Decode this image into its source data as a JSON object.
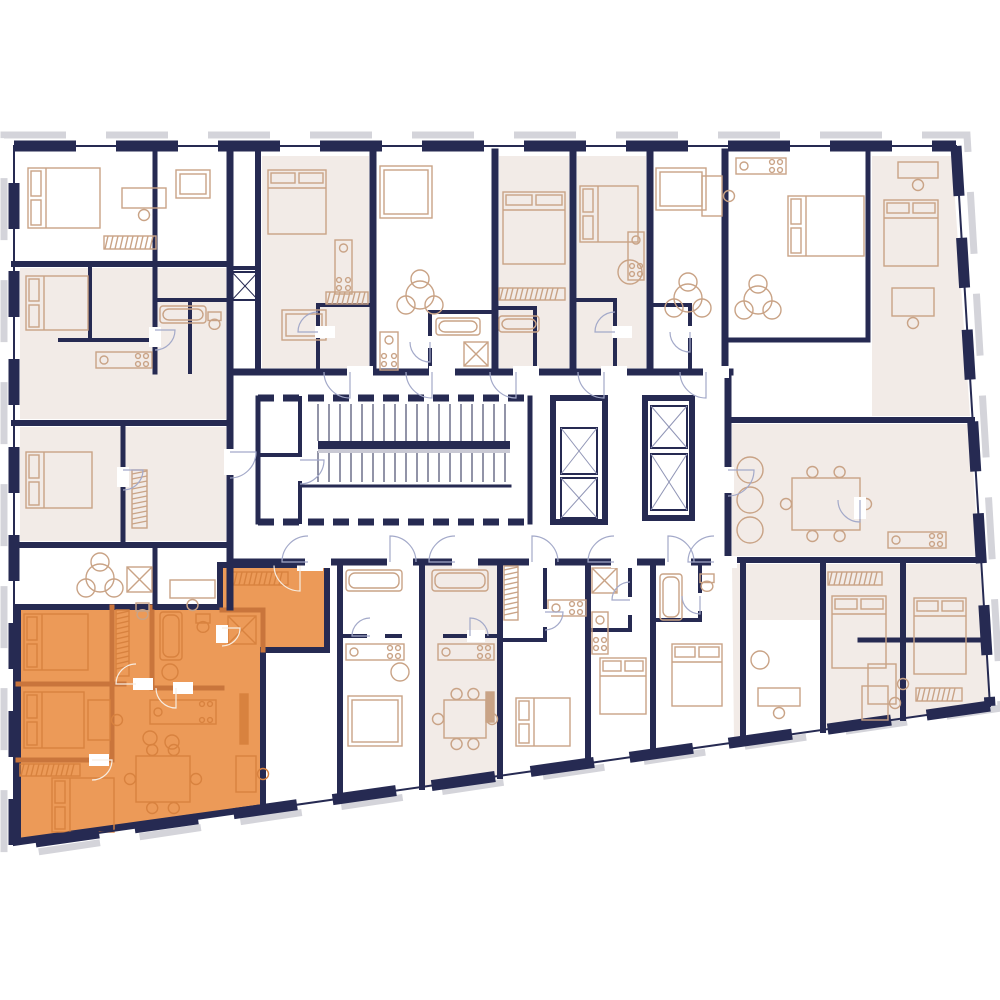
{
  "canvas": {
    "w": 1000,
    "h": 1000,
    "bg": "#ffffff"
  },
  "palette": {
    "wall_navy": "#262a52",
    "furniture_tan": "#c9a386",
    "room_pink": "#f2ebe7",
    "highlight_orange": "#EC9A58",
    "highlight_wall": "#c9753c",
    "highlight_furniture": "#d8823f",
    "door_arc": "#a3a9c9",
    "door_arc_light": "#f7ede2",
    "hatch_gray": "#d4d4da",
    "stair_shadow": "#c9c9d4",
    "white": "#ffffff"
  },
  "building": {
    "outline_points": [
      [
        14,
        146
      ],
      [
        956,
        146
      ],
      [
        990,
        706
      ],
      [
        14,
        845
      ]
    ],
    "hatch_points": [
      [
        4,
        135
      ],
      [
        967,
        135
      ],
      [
        1001,
        708
      ],
      [
        4,
        857
      ]
    ],
    "wall_thickness": 11,
    "edge_dashes": {
      "top": "62 40",
      "right": "50 42",
      "bottom": "64 36",
      "left": "46 42"
    }
  },
  "pink_rooms": [
    [
      [
        20,
        268
      ],
      [
        226,
        268
      ],
      [
        226,
        419
      ],
      [
        20,
        419
      ]
    ],
    [
      [
        20,
        427
      ],
      [
        226,
        427
      ],
      [
        226,
        541
      ],
      [
        20,
        541
      ]
    ],
    [
      [
        262,
        156
      ],
      [
        369,
        156
      ],
      [
        369,
        368
      ],
      [
        262,
        368
      ]
    ],
    [
      [
        499,
        156
      ],
      [
        569,
        156
      ],
      [
        569,
        368
      ],
      [
        499,
        368
      ]
    ],
    [
      [
        577,
        156
      ],
      [
        646,
        156
      ],
      [
        646,
        368
      ],
      [
        577,
        368
      ]
    ],
    [
      [
        872,
        156
      ],
      [
        952,
        156
      ],
      [
        970,
        416
      ],
      [
        872,
        416
      ]
    ],
    [
      [
        732,
        424
      ],
      [
        970,
        424
      ],
      [
        979,
        556
      ],
      [
        732,
        556
      ]
    ],
    [
      [
        732,
        564
      ],
      [
        980,
        564
      ],
      [
        990,
        706
      ],
      [
        734,
        740
      ]
    ],
    [
      [
        425,
        565
      ],
      [
        497,
        565
      ],
      [
        497,
        777
      ],
      [
        425,
        788
      ]
    ]
  ],
  "white_overlays": [
    [
      [
        746,
        620
      ],
      [
        820,
        620
      ],
      [
        820,
        730
      ],
      [
        746,
        739
      ]
    ]
  ],
  "walls": [
    [
      230,
      152,
      230,
      607,
      7
    ],
    [
      14,
      264,
      230,
      264,
      6
    ],
    [
      155,
      152,
      155,
      264,
      5
    ],
    [
      90,
      264,
      90,
      340,
      4
    ],
    [
      60,
      340,
      155,
      340,
      4
    ],
    [
      155,
      264,
      155,
      372,
      5
    ],
    [
      155,
      300,
      230,
      300,
      4
    ],
    [
      190,
      300,
      190,
      372,
      4
    ],
    [
      14,
      423,
      230,
      423,
      6
    ],
    [
      123,
      427,
      123,
      545,
      5
    ],
    [
      14,
      545,
      230,
      545,
      6
    ],
    [
      155,
      545,
      155,
      607,
      5
    ],
    [
      258,
      152,
      258,
      372,
      6
    ],
    [
      232,
      268,
      258,
      268,
      4
    ],
    [
      318,
      305,
      373,
      305,
      4
    ],
    [
      318,
      305,
      318,
      372,
      4
    ],
    [
      373,
      152,
      373,
      372,
      7
    ],
    [
      430,
      312,
      495,
      312,
      4
    ],
    [
      430,
      312,
      430,
      372,
      4
    ],
    [
      495,
      152,
      495,
      372,
      7
    ],
    [
      495,
      308,
      535,
      308,
      4
    ],
    [
      535,
      308,
      535,
      372,
      4
    ],
    [
      573,
      152,
      573,
      372,
      7
    ],
    [
      573,
      300,
      615,
      300,
      4
    ],
    [
      615,
      300,
      615,
      372,
      4
    ],
    [
      650,
      152,
      650,
      372,
      7
    ],
    [
      650,
      305,
      690,
      305,
      4
    ],
    [
      690,
      305,
      690,
      372,
      4
    ],
    [
      725,
      152,
      725,
      372,
      7
    ],
    [
      725,
      340,
      868,
      340,
      5
    ],
    [
      868,
      152,
      868,
      340,
      5
    ],
    [
      230,
      372,
      730,
      372,
      7
    ],
    [
      230,
      562,
      730,
      562,
      7
    ],
    [
      728,
      372,
      728,
      562,
      7
    ],
    [
      728,
      420,
      972,
      420,
      6
    ],
    [
      728,
      560,
      980,
      560,
      6
    ],
    [
      340,
      562,
      340,
      798,
      6
    ],
    [
      422,
      562,
      422,
      787,
      6
    ],
    [
      500,
      562,
      500,
      776,
      6
    ],
    [
      588,
      562,
      588,
      763,
      6
    ],
    [
      653,
      562,
      653,
      754,
      6
    ],
    [
      743,
      560,
      743,
      741,
      6
    ],
    [
      823,
      560,
      823,
      730,
      6
    ],
    [
      903,
      560,
      903,
      718,
      6
    ],
    [
      340,
      636,
      400,
      636,
      4
    ],
    [
      445,
      636,
      500,
      636,
      4
    ],
    [
      545,
      562,
      545,
      640,
      4
    ],
    [
      500,
      640,
      545,
      640,
      4
    ],
    [
      588,
      630,
      630,
      630,
      4
    ],
    [
      630,
      562,
      630,
      630,
      4
    ],
    [
      653,
      620,
      700,
      620,
      4
    ],
    [
      700,
      562,
      700,
      620,
      4
    ],
    [
      860,
      640,
      986,
      640,
      5
    ],
    [
      258,
      398,
      258,
      522,
      5
    ],
    [
      300,
      398,
      300,
      522,
      4
    ],
    [
      258,
      455,
      300,
      455,
      4
    ],
    [
      530,
      398,
      530,
      522,
      5
    ],
    [
      302,
      486,
      510,
      486,
      3
    ]
  ],
  "stairs": {
    "x": 302,
    "y": 400,
    "w": 226,
    "h": 120,
    "tread_x1": 318,
    "tread_x2": 510,
    "step": 11,
    "band1": [
      404,
      441
    ],
    "band2": [
      451,
      482
    ],
    "mid_bar": [
      318,
      441,
      192,
      8
    ],
    "post_walls": [
      [
        258,
        398,
        530,
        398
      ],
      [
        258,
        522,
        530,
        522
      ]
    ],
    "post_dash": "16 9"
  },
  "elevators": {
    "banks": [
      [
        553,
        398,
        52,
        124
      ],
      [
        645,
        398,
        47,
        120
      ]
    ],
    "shafts": [
      [
        561,
        428,
        36,
        46
      ],
      [
        561,
        478,
        36,
        40
      ],
      [
        651,
        406,
        36,
        42
      ],
      [
        651,
        454,
        36,
        56
      ]
    ]
  },
  "small_shafts": [
    [
      232,
      272,
      26,
      28
    ]
  ],
  "furniture": [
    [
      "bed",
      28,
      168,
      72,
      60
    ],
    [
      "hatch",
      104,
      236,
      52,
      13
    ],
    [
      "desk",
      122,
      188,
      44,
      20
    ],
    [
      "sofa",
      176,
      170,
      34,
      28
    ],
    [
      "bed",
      26,
      276,
      62,
      54
    ],
    [
      "kitchen",
      96,
      352,
      56,
      16
    ],
    [
      "tub",
      160,
      306,
      46,
      17
    ],
    [
      "wc",
      208,
      312,
      13,
      17
    ],
    [
      "bed",
      26,
      452,
      66,
      56
    ],
    [
      "hatch",
      132,
      470,
      15,
      58
    ],
    [
      "shower",
      127,
      567,
      25,
      25
    ],
    [
      "wc",
      136,
      603,
      13,
      16
    ],
    [
      "rtable3",
      100,
      578,
      0,
      0
    ],
    [
      "desk",
      170,
      580,
      45,
      18
    ],
    [
      "bed",
      268,
      170,
      58,
      64
    ],
    [
      "kitchen",
      335,
      240,
      17,
      54
    ],
    [
      "hatch",
      326,
      292,
      42,
      12
    ],
    [
      "sofa",
      282,
      310,
      44,
      30
    ],
    [
      "sofa",
      380,
      166,
      52,
      52
    ],
    [
      "rtable3",
      420,
      295,
      0,
      0
    ],
    [
      "kitchen",
      380,
      332,
      18,
      38
    ],
    [
      "tub",
      436,
      318,
      44,
      17
    ],
    [
      "shower",
      464,
      342,
      24,
      24
    ],
    [
      "bed",
      503,
      192,
      62,
      72
    ],
    [
      "hatch",
      499,
      288,
      66,
      12
    ],
    [
      "tub",
      499,
      316,
      40,
      16
    ],
    [
      "bed",
      580,
      186,
      58,
      56
    ],
    [
      "circle",
      630,
      272,
      24,
      0
    ],
    [
      "kitchen",
      628,
      232,
      16,
      48
    ],
    [
      "sofa",
      656,
      168,
      50,
      42
    ],
    [
      "rtable3",
      688,
      298,
      0,
      0
    ],
    [
      "desk",
      702,
      176,
      20,
      40
    ],
    [
      "kitchen",
      736,
      158,
      50,
      16
    ],
    [
      "rtable3",
      758,
      300,
      0,
      0
    ],
    [
      "bed",
      788,
      196,
      76,
      60
    ],
    [
      "bed",
      884,
      200,
      54,
      66
    ],
    [
      "desk",
      898,
      162,
      40,
      16
    ],
    [
      "desk",
      892,
      288,
      42,
      28
    ],
    [
      "circle",
      750,
      470,
      26,
      0
    ],
    [
      "circle",
      750,
      500,
      26,
      0
    ],
    [
      "circle",
      750,
      530,
      26,
      0
    ],
    [
      "dining",
      792,
      478,
      68,
      52
    ],
    [
      "kitchen",
      888,
      532,
      58,
      16
    ],
    [
      "bed",
      914,
      598,
      52,
      76
    ],
    [
      "hatch",
      916,
      688,
      46,
      13
    ],
    [
      "desk",
      868,
      664,
      28,
      40
    ],
    [
      "hatch",
      828,
      572,
      54,
      13
    ],
    [
      "bed",
      832,
      596,
      54,
      72
    ],
    [
      "desk",
      862,
      686,
      26,
      34
    ],
    [
      "desk",
      758,
      688,
      42,
      18
    ],
    [
      "circle",
      760,
      660,
      18,
      0
    ],
    [
      "tub",
      660,
      574,
      22,
      46
    ],
    [
      "wc",
      700,
      574,
      14,
      17
    ],
    [
      "bed",
      672,
      644,
      50,
      62
    ],
    [
      "tub",
      346,
      570,
      56,
      21
    ],
    [
      "kitchen",
      346,
      644,
      58,
      16
    ],
    [
      "sofa",
      348,
      696,
      54,
      50
    ],
    [
      "circle",
      400,
      672,
      18,
      0
    ],
    [
      "tub",
      432,
      570,
      56,
      21
    ],
    [
      "kitchen",
      438,
      644,
      56,
      16
    ],
    [
      "dining",
      444,
      700,
      42,
      38
    ],
    [
      "tv",
      486,
      692,
      8,
      30
    ],
    [
      "hatch",
      504,
      566,
      14,
      54
    ],
    [
      "kitchen",
      548,
      600,
      38,
      16
    ],
    [
      "bed",
      516,
      698,
      54,
      48
    ],
    [
      "shower",
      592,
      568,
      25,
      25
    ],
    [
      "kitchen",
      592,
      612,
      16,
      42
    ],
    [
      "bed",
      600,
      658,
      46,
      56
    ]
  ],
  "doors": [
    [
      350,
      372,
      26,
      90,
      "h"
    ],
    [
      432,
      372,
      26,
      90,
      "h"
    ],
    [
      516,
      372,
      26,
      90,
      "h"
    ],
    [
      604,
      372,
      26,
      90,
      "h"
    ],
    [
      706,
      372,
      26,
      90,
      "h"
    ],
    [
      308,
      562,
      26,
      180,
      "h"
    ],
    [
      390,
      562,
      26,
      270,
      "h"
    ],
    [
      455,
      562,
      26,
      180,
      "h"
    ],
    [
      532,
      562,
      26,
      270,
      "h"
    ],
    [
      614,
      562,
      26,
      180,
      "h"
    ],
    [
      668,
      562,
      26,
      270,
      "h"
    ],
    [
      714,
      562,
      26,
      180,
      "h"
    ],
    [
      230,
      452,
      26,
      0,
      "v"
    ],
    [
      300,
      460,
      24,
      0,
      "v"
    ],
    [
      728,
      470,
      26,
      0,
      "v"
    ],
    [
      318,
      332,
      20,
      180,
      "h"
    ],
    [
      430,
      342,
      20,
      90,
      "h"
    ],
    [
      615,
      332,
      20,
      180,
      "h"
    ],
    [
      690,
      332,
      20,
      90,
      "h"
    ],
    [
      155,
      330,
      20,
      0,
      "v"
    ],
    [
      123,
      470,
      20,
      0,
      "v"
    ],
    [
      370,
      636,
      18,
      180,
      "h"
    ],
    [
      470,
      636,
      18,
      270,
      "h"
    ],
    [
      545,
      612,
      18,
      0,
      "v"
    ],
    [
      630,
      600,
      18,
      180,
      "v"
    ],
    [
      700,
      596,
      18,
      90,
      "v"
    ],
    [
      860,
      500,
      22,
      90,
      "v"
    ]
  ],
  "highlight_unit": {
    "polygon": [
      [
        18,
        607
      ],
      [
        220,
        607
      ],
      [
        220,
        565
      ],
      [
        327,
        565
      ],
      [
        327,
        650
      ],
      [
        263,
        650
      ],
      [
        263,
        807
      ],
      [
        18,
        841
      ]
    ],
    "walls": [
      [
        18,
        684,
        124,
        684
      ],
      [
        112,
        607,
        112,
        684
      ],
      [
        18,
        760,
        112,
        760
      ],
      [
        112,
        684,
        112,
        760
      ],
      [
        152,
        607,
        152,
        688
      ],
      [
        152,
        688,
        222,
        688
      ],
      [
        222,
        610,
        263,
        610
      ],
      [
        263,
        610,
        263,
        650
      ]
    ],
    "furniture": [
      [
        "bed",
        24,
        614,
        64,
        56
      ],
      [
        "hatch",
        116,
        610,
        13,
        66
      ],
      [
        "bed",
        24,
        692,
        60,
        56
      ],
      [
        "desk",
        88,
        700,
        22,
        40
      ],
      [
        "bed",
        52,
        778,
        62,
        54
      ],
      [
        "hatch",
        20,
        764,
        60,
        12
      ],
      [
        "tub",
        160,
        612,
        22,
        48
      ],
      [
        "circle",
        170,
        672,
        16,
        0
      ],
      [
        "wc",
        196,
        614,
        14,
        18
      ],
      [
        "shower",
        228,
        616,
        28,
        28
      ],
      [
        "hatch",
        228,
        572,
        60,
        13
      ],
      [
        "kitchen",
        150,
        700,
        66,
        24
      ],
      [
        "circle",
        150,
        738,
        14,
        0
      ],
      [
        "circle",
        172,
        742,
        14,
        0
      ],
      [
        "dining",
        136,
        756,
        54,
        46
      ],
      [
        "tv",
        240,
        694,
        8,
        50
      ],
      [
        "desk",
        236,
        756,
        20,
        36
      ]
    ],
    "doors": [
      [
        300,
        565,
        26,
        90,
        "h"
      ],
      [
        136,
        684,
        20,
        180,
        "h"
      ],
      [
        92,
        760,
        20,
        0,
        "h"
      ],
      [
        176,
        688,
        20,
        90,
        "h"
      ],
      [
        222,
        628,
        18,
        0,
        "v"
      ]
    ]
  }
}
